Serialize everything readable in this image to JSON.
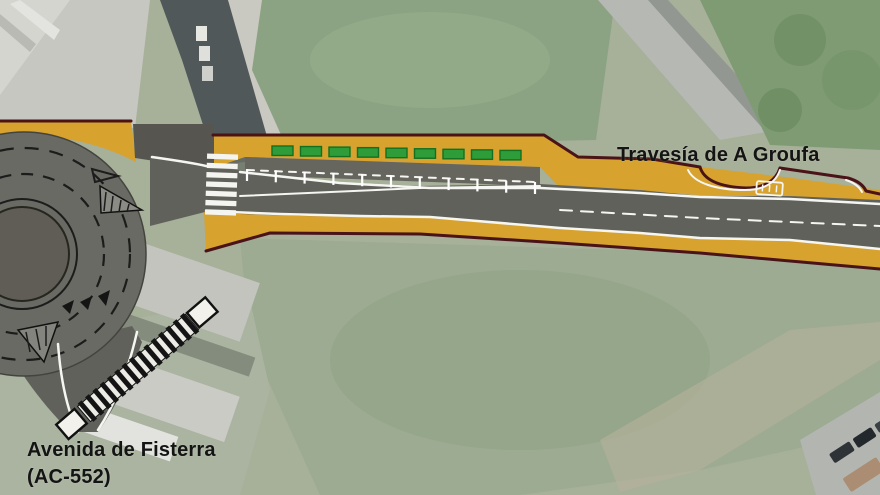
{
  "canvas": {
    "width": 880,
    "height": 495,
    "kind": "aerial-photo-with-road-plan-overlay"
  },
  "labels": {
    "street_top": "Travesía de A Groufa",
    "avenue_line1": "Avenida de Fisterra",
    "avenue_line2": "(AC-552)"
  },
  "palette": {
    "sidewalk_ochre": "#D7A22E",
    "road_gray": "#61615C",
    "boundary_maroon": "#4A1318",
    "planter_green": "#2E9C39",
    "marking_white": "#F5F5F1",
    "satellite_green": "#9AAA8E"
  },
  "plan": {
    "planters": {
      "count": 9,
      "x0": 272,
      "step": 28.5,
      "y0": 146,
      "ystep": 0.55,
      "w": 21,
      "h": 9.5
    },
    "parking_ticks": {
      "count": 11,
      "x0": 247,
      "step": 28.8,
      "y0": 169,
      "ystep": 1.3,
      "len": 12
    },
    "crosswalk": {
      "count": 7,
      "x": 206,
      "w": 31,
      "y0": 154,
      "step": 9.3,
      "h": 5.3
    },
    "stairs": {
      "count": 15,
      "x0": 2,
      "step": 9.6,
      "y": -12,
      "w": 5,
      "h": 24
    }
  },
  "features": {
    "roundabout": "roundabout with central island and dashed circulating lanes",
    "crosswalk": "zebra crossing at roundabout east leg",
    "parking": "parking bays with green planters along north side",
    "stairs": "striped pedestrian stair ramp south-west of roundabout",
    "bus_bay": "bus bay marking on right section"
  }
}
